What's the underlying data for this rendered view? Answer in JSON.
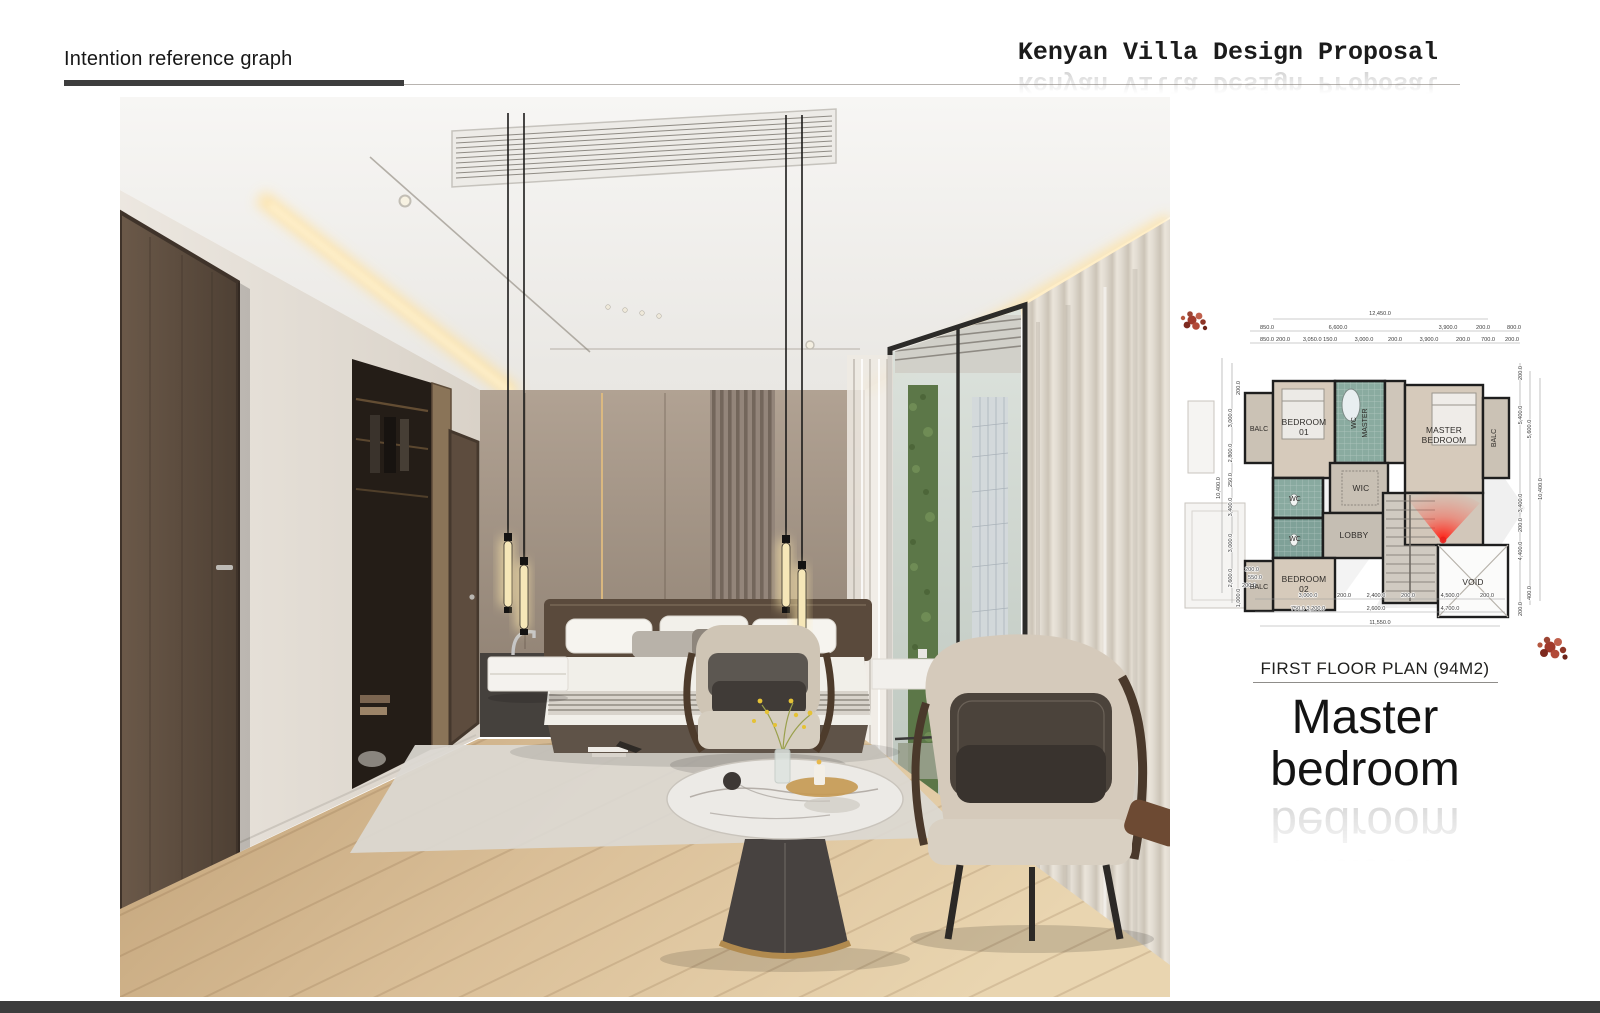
{
  "header": {
    "section_label": "Intention reference graph",
    "title": "Kenyan Villa Design Proposal"
  },
  "plan": {
    "caption": "FIRST FLOOR PLAN (94M2)",
    "rooms": {
      "balc_tl": "BALC",
      "bedroom01_line1": "BEDROOM",
      "bedroom01_line2": "01",
      "wc_master_line1": "WC",
      "wc_master_line2": "MASTER",
      "master_line1": "MASTER",
      "master_line2": "BEDROOM",
      "balc_right": "BALC",
      "wic": "WIC",
      "wc_upper": "WC",
      "wc_lower": "WC",
      "lobby": "LOBBY",
      "bedroom02_line1": "BEDROOM",
      "bedroom02_line2": "02",
      "balc_bl": "BALC",
      "void": "VOID"
    },
    "dimensions": [
      {
        "t": "12,450.0",
        "x": 210,
        "y": 22
      },
      {
        "t": "850.0",
        "x": 97,
        "y": 36
      },
      {
        "t": "6,600.0",
        "x": 168,
        "y": 36
      },
      {
        "t": "3,900.0",
        "x": 278,
        "y": 36
      },
      {
        "t": "200.0",
        "x": 313,
        "y": 36
      },
      {
        "t": "800.0",
        "x": 344,
        "y": 36
      },
      {
        "t": "850.0",
        "x": 97,
        "y": 48
      },
      {
        "t": "200.0",
        "x": 113,
        "y": 48
      },
      {
        "t": "3,050.0 150.0",
        "x": 150,
        "y": 48
      },
      {
        "t": "3,000.0",
        "x": 194,
        "y": 48
      },
      {
        "t": "200.0",
        "x": 225,
        "y": 48
      },
      {
        "t": "3,900.0",
        "x": 259,
        "y": 48
      },
      {
        "t": "200.0",
        "x": 293,
        "y": 48
      },
      {
        "t": "700.0",
        "x": 318,
        "y": 48
      },
      {
        "t": "200.0",
        "x": 342,
        "y": 48
      },
      {
        "t": "200.0",
        "x": 82,
        "y": 278
      },
      {
        "t": "550.0",
        "x": 85,
        "y": 286
      },
      {
        "t": "200.0",
        "x": 79,
        "y": 294
      },
      {
        "t": "3,000.0",
        "x": 138,
        "y": 304
      },
      {
        "t": "200.0",
        "x": 174,
        "y": 304
      },
      {
        "t": "2,400.0",
        "x": 206,
        "y": 304
      },
      {
        "t": "200.0",
        "x": 238,
        "y": 304
      },
      {
        "t": "4,500.0",
        "x": 280,
        "y": 304
      },
      {
        "t": "200.0",
        "x": 317,
        "y": 304
      },
      {
        "t": "750.0 3,200.0",
        "x": 138,
        "y": 317
      },
      {
        "t": "2,600.0",
        "x": 206,
        "y": 317
      },
      {
        "t": "4,700.0",
        "x": 280,
        "y": 317
      },
      {
        "t": "11,550.0",
        "x": 210,
        "y": 331
      },
      {
        "t": "200.0",
        "x": 70,
        "y": 95,
        "r": -90
      },
      {
        "t": "3,000.0",
        "x": 62,
        "y": 125,
        "r": -90
      },
      {
        "t": "2,800.0",
        "x": 62,
        "y": 160,
        "r": -90
      },
      {
        "t": "250.0",
        "x": 62,
        "y": 187,
        "r": -90
      },
      {
        "t": "3,400.0",
        "x": 62,
        "y": 214,
        "r": -90
      },
      {
        "t": "3,000.0",
        "x": 62,
        "y": 250,
        "r": -90
      },
      {
        "t": "2,600.0",
        "x": 62,
        "y": 285,
        "r": -90
      },
      {
        "t": "10,400.0",
        "x": 50,
        "y": 195,
        "r": -90
      },
      {
        "t": "1,000.0",
        "x": 70,
        "y": 305,
        "r": -90
      },
      {
        "t": "200.0",
        "x": 352,
        "y": 80,
        "r": -90
      },
      {
        "t": "5,400.0",
        "x": 352,
        "y": 122,
        "r": -90
      },
      {
        "t": "5,600.0",
        "x": 361,
        "y": 136,
        "r": -90
      },
      {
        "t": "10,400.0",
        "x": 372,
        "y": 196,
        "r": -90
      },
      {
        "t": "3,400.0",
        "x": 352,
        "y": 210,
        "r": -90
      },
      {
        "t": "200.0",
        "x": 352,
        "y": 232,
        "r": -90
      },
      {
        "t": "4,400.0",
        "x": 352,
        "y": 258,
        "r": -90
      },
      {
        "t": "400.0",
        "x": 361,
        "y": 300,
        "r": -90
      },
      {
        "t": "200.0",
        "x": 352,
        "y": 316,
        "r": -90
      }
    ]
  },
  "headline": {
    "line1": "Master",
    "line2": "bedroom"
  },
  "colors": {
    "accent_red": "#e8211d",
    "rule_dark": "#3d3d3d",
    "footer_bar": "#3c3c3c",
    "plan_wall": "#1e1e1e",
    "cove_glow": "#ffe3a6",
    "wood_floor": "#d9bc94",
    "headboard_wall": "#9b8c7d"
  }
}
